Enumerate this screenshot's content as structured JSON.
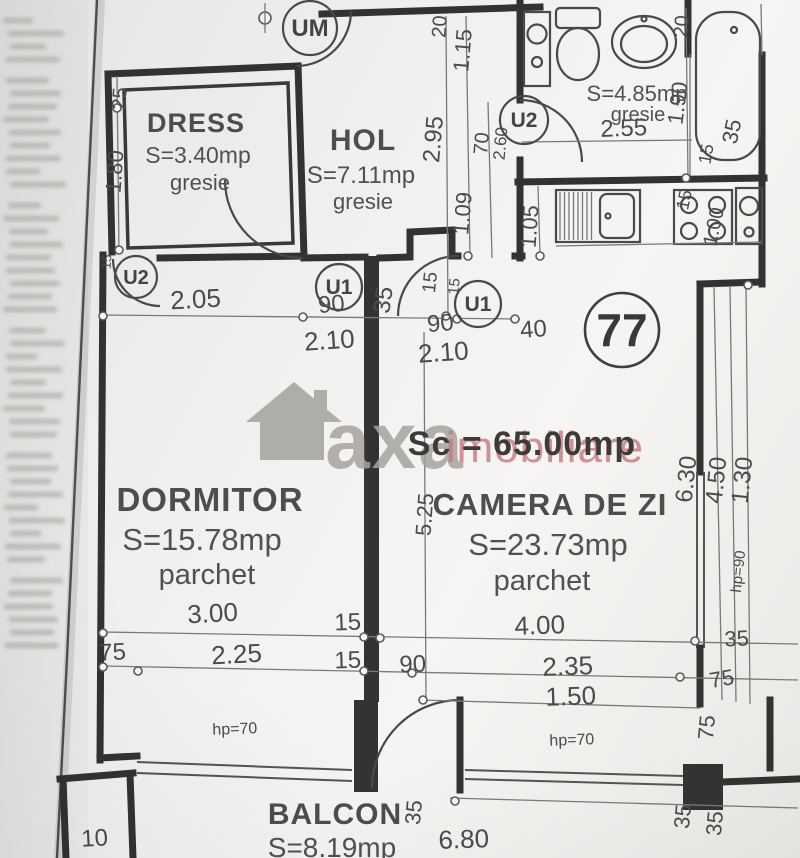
{
  "plan": {
    "unit_number": "77",
    "area_total": "Sc = 65.00mp",
    "watermark": {
      "brand": "axa",
      "suffix": "imobiliare"
    },
    "rooms": [
      {
        "name": "DRESS",
        "area": "S=3.40mp",
        "floor": "gresie"
      },
      {
        "name": "HOL",
        "area": "S=7.11mp",
        "floor": "gresie"
      },
      {
        "name": "",
        "area": "S=4.85mp",
        "floor": "gresie"
      },
      {
        "name": "DORMITOR",
        "area": "S=15.78mp",
        "floor": "parchet"
      },
      {
        "name": "CAMERA DE ZI",
        "area": "S=23.73mp",
        "floor": "parchet"
      },
      {
        "name": "BALCON",
        "area": "S=8.19mp",
        "floor": ""
      }
    ],
    "doors": [
      {
        "label": "UM"
      },
      {
        "label": "U2"
      },
      {
        "label": "U1"
      },
      {
        "label": "U1"
      },
      {
        "label": "U2"
      }
    ],
    "dim_labels": [
      {
        "t": "25",
        "x": 126,
        "y": 99,
        "r": -86,
        "s": 20
      },
      {
        "t": "1.80",
        "x": 122,
        "y": 172,
        "r": -86,
        "s": 22
      },
      {
        "t": "15",
        "x": 111,
        "y": 262,
        "r": -86,
        "s": 13
      },
      {
        "t": "2.05",
        "x": 196,
        "y": 308,
        "r": -3,
        "s": 26
      },
      {
        "t": "90",
        "x": 332,
        "y": 312,
        "r": -5,
        "s": 24
      },
      {
        "t": "2.10",
        "x": 330,
        "y": 349,
        "r": -4,
        "s": 26
      },
      {
        "t": "35",
        "x": 391,
        "y": 301,
        "r": -82,
        "s": 24
      },
      {
        "t": "15",
        "x": 436,
        "y": 283,
        "r": -84,
        "s": 19
      },
      {
        "t": "15",
        "x": 459,
        "y": 287,
        "r": -84,
        "s": 15
      },
      {
        "t": "90",
        "x": 441,
        "y": 331,
        "r": -5,
        "s": 24
      },
      {
        "t": "2.10",
        "x": 444,
        "y": 361,
        "r": -4,
        "s": 26
      },
      {
        "t": "40",
        "x": 534,
        "y": 337,
        "r": -4,
        "s": 24
      },
      {
        "t": "20",
        "x": 446,
        "y": 27,
        "r": -86,
        "s": 20
      },
      {
        "t": "2.95",
        "x": 441,
        "y": 140,
        "r": -85,
        "s": 24
      },
      {
        "t": "1.15",
        "x": 470,
        "y": 51,
        "r": -85,
        "s": 22
      },
      {
        "t": "1.09",
        "x": 470,
        "y": 214,
        "r": -85,
        "s": 22
      },
      {
        "t": "70",
        "x": 488,
        "y": 144,
        "r": -85,
        "s": 20
      },
      {
        "t": "2.60",
        "x": 506,
        "y": 144,
        "r": -85,
        "s": 17
      },
      {
        "t": "2.55",
        "x": 624,
        "y": 136,
        "r": -2,
        "s": 24
      },
      {
        "t": "35",
        "x": 739,
        "y": 133,
        "r": -78,
        "s": 22
      },
      {
        "t": "20",
        "x": 688,
        "y": 27,
        "r": -85,
        "s": 20
      },
      {
        "t": "1.90",
        "x": 685,
        "y": 104,
        "r": -83,
        "s": 22
      },
      {
        "t": "15",
        "x": 712,
        "y": 155,
        "r": -80,
        "s": 18
      },
      {
        "t": "1.05",
        "x": 537,
        "y": 227,
        "r": -86,
        "s": 22
      },
      {
        "t": "15",
        "x": 690,
        "y": 201,
        "r": -78,
        "s": 18
      },
      {
        "t": "1.00",
        "x": 720,
        "y": 228,
        "r": -78,
        "s": 20
      },
      {
        "t": "5.25",
        "x": 432,
        "y": 515,
        "r": -86,
        "s": 22
      },
      {
        "t": "6.30",
        "x": 694,
        "y": 480,
        "r": -84,
        "s": 24
      },
      {
        "t": "4.50",
        "x": 724,
        "y": 481,
        "r": -84,
        "s": 24
      },
      {
        "t": "1.30",
        "x": 750,
        "y": 481,
        "r": -84,
        "s": 24
      },
      {
        "t": "hp=90",
        "x": 743,
        "y": 572,
        "r": -84,
        "s": 15
      },
      {
        "t": "35",
        "x": 737,
        "y": 646,
        "r": -3,
        "s": 22
      },
      {
        "t": "75",
        "x": 723,
        "y": 686,
        "r": -10,
        "s": 22
      },
      {
        "t": "3.00",
        "x": 213,
        "y": 622,
        "r": -3,
        "s": 26
      },
      {
        "t": "15",
        "x": 348,
        "y": 630,
        "r": -2,
        "s": 24
      },
      {
        "t": "4.00",
        "x": 540,
        "y": 634,
        "r": -2,
        "s": 26
      },
      {
        "t": "75",
        "x": 113,
        "y": 660,
        "r": -3,
        "s": 24
      },
      {
        "t": "2.25",
        "x": 237,
        "y": 663,
        "r": -3,
        "s": 26
      },
      {
        "t": "15",
        "x": 348,
        "y": 668,
        "r": -2,
        "s": 24
      },
      {
        "t": "90",
        "x": 413,
        "y": 672,
        "r": -2,
        "s": 24
      },
      {
        "t": "2.35",
        "x": 568,
        "y": 675,
        "r": -2,
        "s": 26
      },
      {
        "t": "1.50",
        "x": 571,
        "y": 705,
        "r": -2,
        "s": 26
      },
      {
        "t": "hp=70",
        "x": 235,
        "y": 734,
        "r": -2,
        "s": 16
      },
      {
        "t": "hp=70",
        "x": 572,
        "y": 745,
        "r": -2,
        "s": 16
      },
      {
        "t": "75",
        "x": 714,
        "y": 728,
        "r": -85,
        "s": 22
      },
      {
        "t": "35",
        "x": 690,
        "y": 817,
        "r": -85,
        "s": 22
      },
      {
        "t": "35",
        "x": 722,
        "y": 824,
        "r": -85,
        "s": 22
      },
      {
        "t": "35",
        "x": 421,
        "y": 813,
        "r": -85,
        "s": 22
      },
      {
        "t": "6.80",
        "x": 464,
        "y": 848,
        "r": -2,
        "s": 26
      },
      {
        "t": "10",
        "x": 95,
        "y": 846,
        "r": -3,
        "s": 24
      }
    ]
  }
}
